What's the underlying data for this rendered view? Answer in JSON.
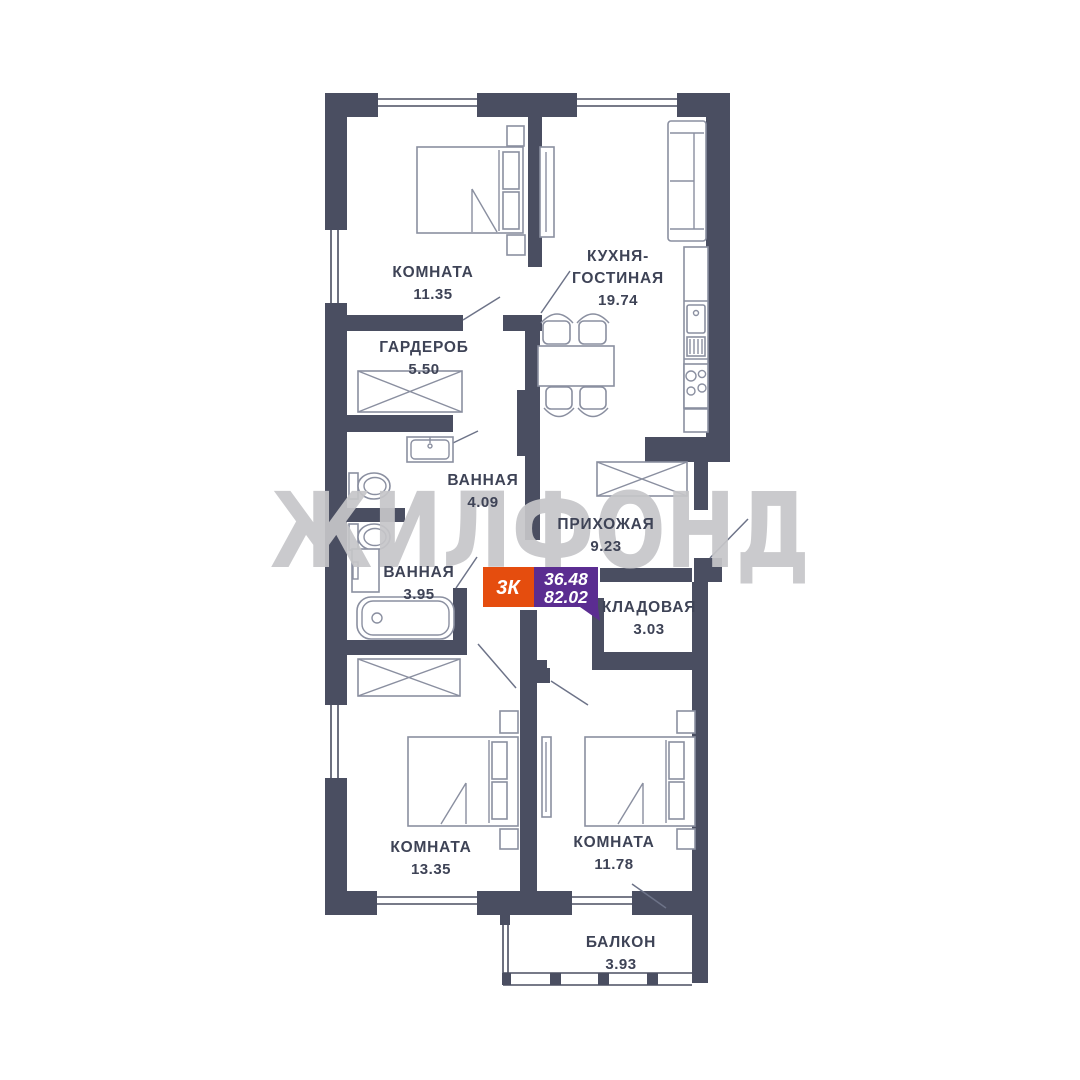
{
  "watermark": {
    "text": "ЖИЛФОНД",
    "color": "#c6c6c9"
  },
  "badge": {
    "type": "3К",
    "living_area": "36.48",
    "total_area": "82.02",
    "type_bg": "#e54d0e",
    "area_bg": "#5b2d91",
    "text_color": "#ffffff"
  },
  "colors": {
    "wall": "#4a4e61",
    "furniture_stroke": "#8a8fa0",
    "label_text": "#3e4356",
    "background": "#ffffff"
  },
  "rooms": {
    "bedroom_top": {
      "name": "КОМНАТА",
      "area": "11.35"
    },
    "kitchen_living": {
      "name_line1": "КУХНЯ-",
      "name_line2": "ГОСТИНАЯ",
      "area": "19.74"
    },
    "wardrobe": {
      "name": "ГАРДЕРОБ",
      "area": "5.50"
    },
    "bathroom_top": {
      "name": "ВАННАЯ",
      "area": "4.09"
    },
    "hallway": {
      "name": "ПРИХОЖАЯ",
      "area": "9.23"
    },
    "bathroom_bottom": {
      "name": "ВАННАЯ",
      "area": "3.95"
    },
    "storage": {
      "name": "КЛАДОВАЯ",
      "area": "3.03"
    },
    "bedroom_left": {
      "name": "КОМНАТА",
      "area": "13.35"
    },
    "bedroom_right": {
      "name": "КОМНАТА",
      "area": "11.78"
    },
    "balcony": {
      "name": "БАЛКОН",
      "area": "3.93"
    }
  }
}
